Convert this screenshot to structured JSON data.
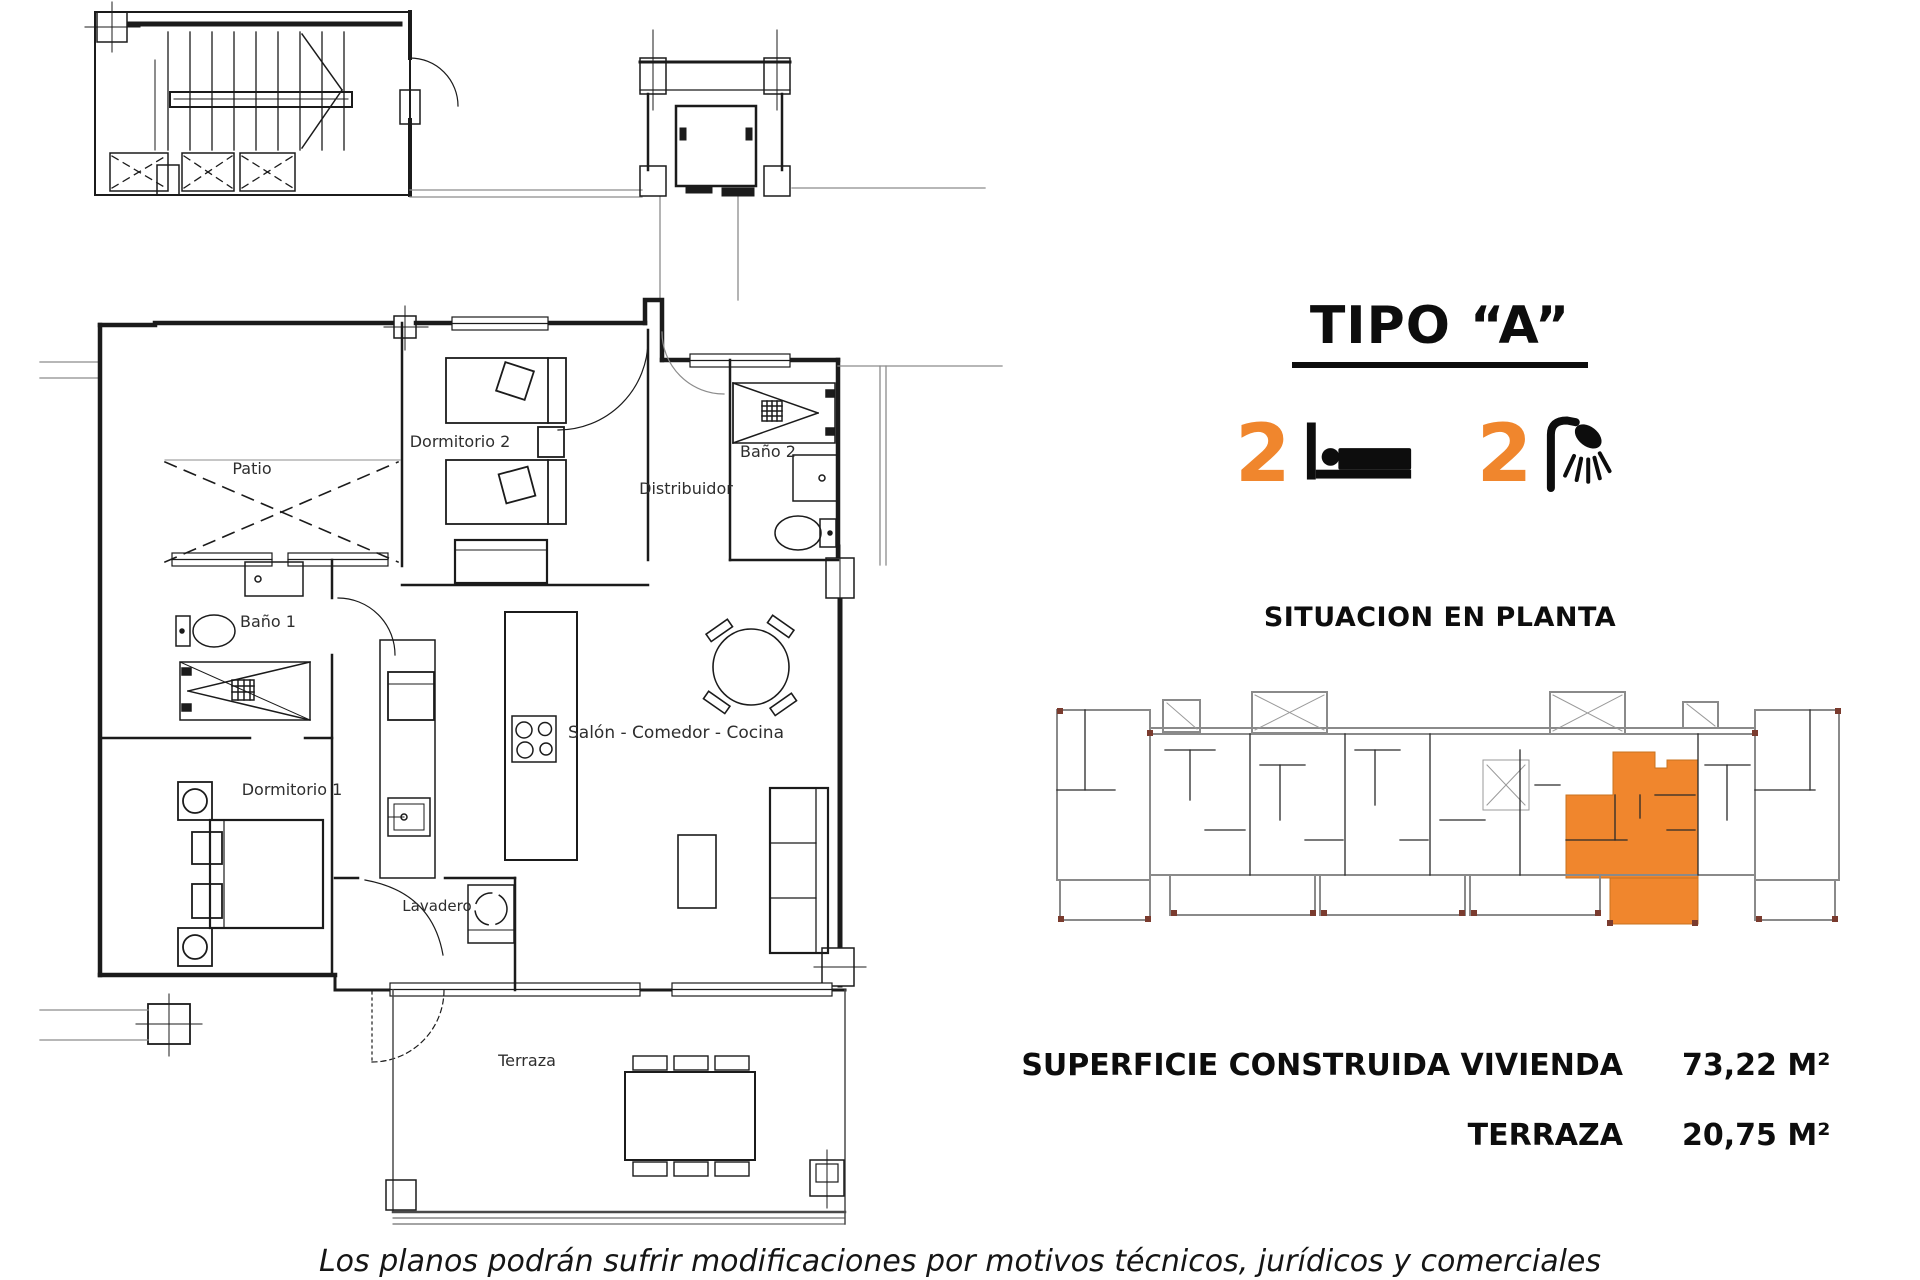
{
  "header": {
    "type_title": "TIPO “A”"
  },
  "stats": {
    "bedrooms": "2",
    "bathrooms": "2"
  },
  "situation": {
    "title": "SITUACION EN PLANTA"
  },
  "surface": {
    "rows": [
      {
        "label": "SUPERFICIE CONSTRUIDA VIVIENDA",
        "value": "73,22 M²"
      },
      {
        "label": "TERRAZA",
        "value": "20,75 M²"
      }
    ]
  },
  "floor_plan": {
    "labels": {
      "patio": "Patio",
      "dormitorio2": "Dormitorio 2",
      "bano2": "Baño 2",
      "distribuidor": "Distribuidor",
      "bano1": "Baño 1",
      "salon": "Salón - Comedor - Cocina",
      "dormitorio1": "Dormitorio 1",
      "lavadero": "Lavadero",
      "terraza": "Terraza"
    }
  },
  "footer": {
    "disclaimer": "Los planos podrán sufrir modificaciones por motivos técnicos, jurídicos y comerciales"
  },
  "colors": {
    "accent_orange": "#F0862D",
    "line": "#1b1b1b"
  }
}
